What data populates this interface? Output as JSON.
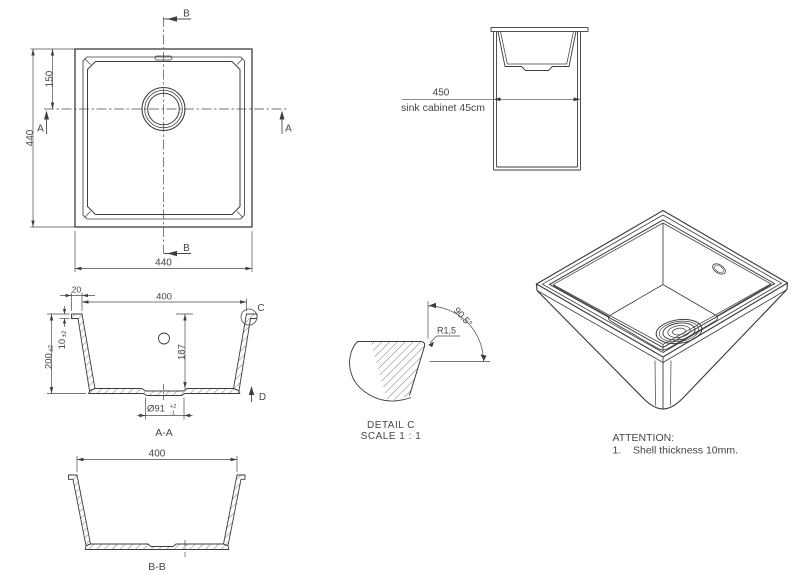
{
  "colors": {
    "line": "#3d3d3d",
    "thin": "#4a4a4a",
    "text": "#454545",
    "bg": "#ffffff"
  },
  "plan": {
    "dim_height": "440",
    "dim_width": "440",
    "dim_drain_offset": "150",
    "marker_a": "A",
    "marker_b": "B"
  },
  "cabinet": {
    "dim": "450",
    "caption": "sink cabinet 45cm"
  },
  "section_aa": {
    "label": "A-A",
    "dim_flange": "20",
    "dim_opening": "400",
    "dim_height": "200",
    "dim_height_tol": "±2",
    "dim_thickness": "10",
    "dim_thickness_tol": "±2",
    "dim_depth": "187",
    "dim_drain": "Ø91",
    "dim_drain_tol_plus": "+2",
    "dim_drain_tol_minus": "-1",
    "detail_marker": "C",
    "direction_marker": "D"
  },
  "section_bb": {
    "label": "B-B",
    "dim_opening": "400"
  },
  "detail_c": {
    "radius": "R1,5",
    "angle": "90.5°",
    "title": "DETAIL C",
    "scale": "SCALE 1 : 1"
  },
  "notes": {
    "title": "ATTENTION:",
    "item_number": "1.",
    "item_text": "Shell thickness 10mm."
  }
}
